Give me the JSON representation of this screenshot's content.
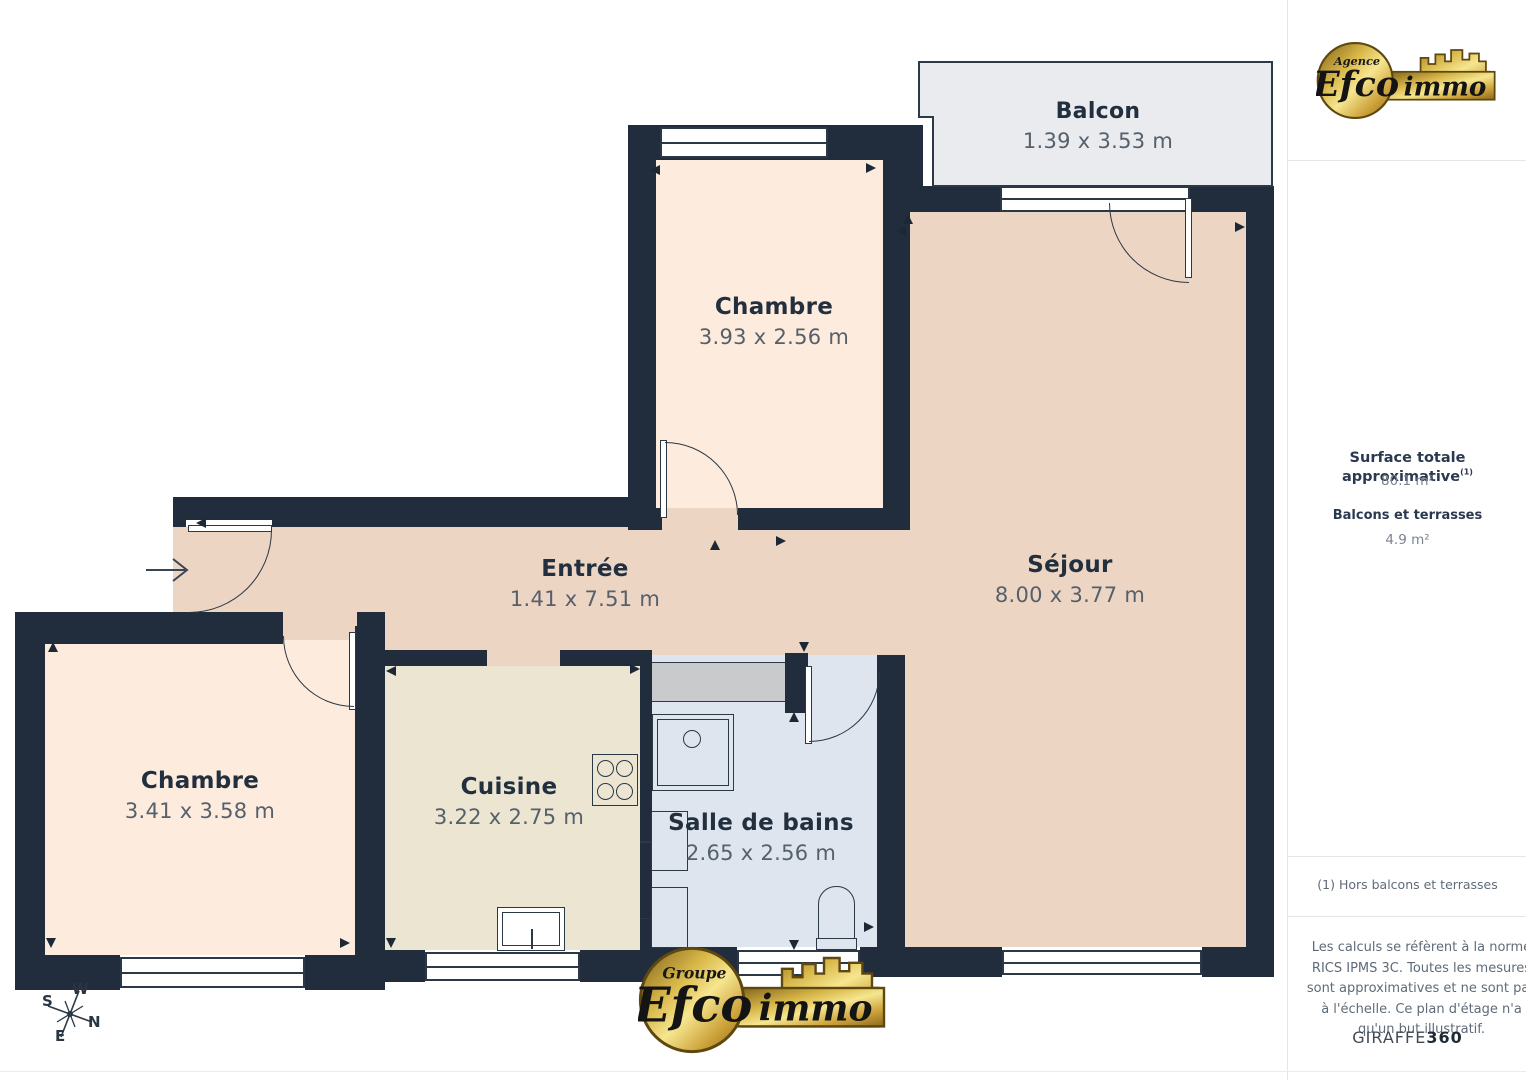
{
  "plan": {
    "rooms": [
      {
        "id": "balcon",
        "name": "Balcon",
        "dims": "1.39 x 3.53 m"
      },
      {
        "id": "chambre-top",
        "name": "Chambre",
        "dims": "3.93 x 2.56 m"
      },
      {
        "id": "sejour",
        "name": "Séjour",
        "dims": "8.00 x 3.77 m"
      },
      {
        "id": "entree",
        "name": "Entrée",
        "dims": "1.41 x 7.51 m"
      },
      {
        "id": "chambre-left",
        "name": "Chambre",
        "dims": "3.41 x 3.58 m"
      },
      {
        "id": "cuisine",
        "name": "Cuisine",
        "dims": "3.22 x 2.75 m"
      },
      {
        "id": "salle-de-bains",
        "name": "Salle de bains",
        "dims": "2.65 x 2.56 m"
      }
    ],
    "compass": {
      "n": "N",
      "s": "S",
      "e": "E",
      "w": "W"
    }
  },
  "logo_top": {
    "prefix": "Agence",
    "brand": "Efco",
    "suffix": "immo"
  },
  "logo_bottom": {
    "prefix": "Groupe",
    "brand": "Efco",
    "suffix": "immo"
  },
  "sidebar": {
    "surface_title": "Surface totale approximative",
    "surface_note_ref": "(1)",
    "surface_value": "80.1 m²",
    "balconies_title": "Balcons et terrasses",
    "balconies_value": "4.9 m²",
    "footnote": "(1) Hors balcons et terrasses",
    "disclaimer": "Les calculs se réfèrent à la norme RICS IPMS 3C. Toutes les mesures sont approximatives et ne sont pas à l'échelle. Ce plan d'étage n'a qu'un but illustratif.",
    "brand_footer_name": "GIRAFFE",
    "brand_footer_suffix": "360"
  },
  "colors": {
    "wall": "#212d3c",
    "bedroom": "#fdecdd",
    "living": "#edd5c3",
    "kitchen": "#ebe5d2",
    "bathroom": "#dfe5ee",
    "balcony": "#e9ebee",
    "counter": "#c9cacb",
    "gold": "#d9b84a"
  }
}
